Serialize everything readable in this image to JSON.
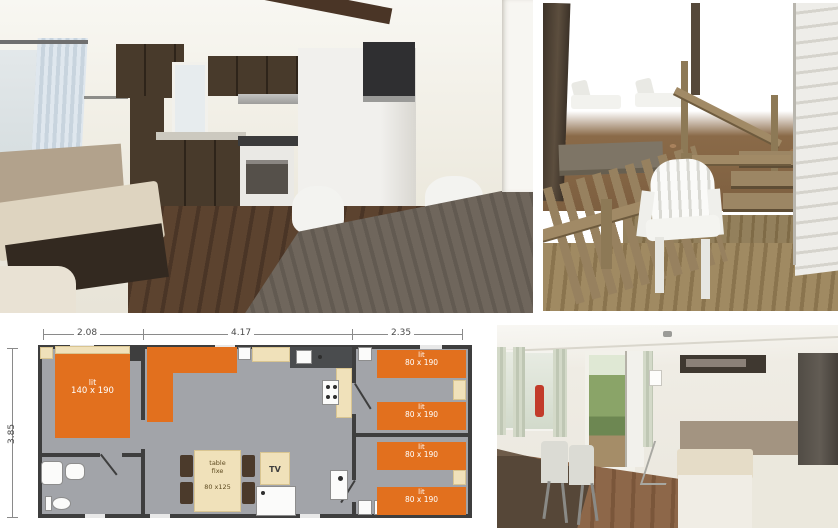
{
  "page": {
    "background": "#ffffff",
    "description_labels": {}
  },
  "photos": {
    "top_left": {
      "name": "interior kitchen and living room"
    },
    "top_right": {
      "name": "wooden deck with white garden chair"
    },
    "bottom_right": {
      "name": "dining area with bench seat"
    }
  },
  "floorplan": {
    "dimensions": {
      "top_left": "2.08",
      "top_middle": "4.17",
      "top_right": "2.35",
      "left_side": "3.85"
    },
    "master_bed": {
      "name": "lit",
      "size": "140 x 190"
    },
    "single_beds": [
      {
        "name": "lit",
        "size": "80 x 190"
      },
      {
        "name": "lit",
        "size": "80 x 190"
      },
      {
        "name": "lit",
        "size": "80 x 190"
      },
      {
        "name": "lit",
        "size": "80 x 190"
      }
    ],
    "table": {
      "line1": "table",
      "line2": "fixe",
      "size": "80 x125"
    },
    "tv": "TV",
    "colors": {
      "furniture_orange": "#e2701e",
      "floor_gray": "#a2a4a9",
      "wall_dark": "#3e3e3e",
      "wood_beige": "#f0e1ba",
      "chair_brown": "#4b3a2b"
    }
  }
}
